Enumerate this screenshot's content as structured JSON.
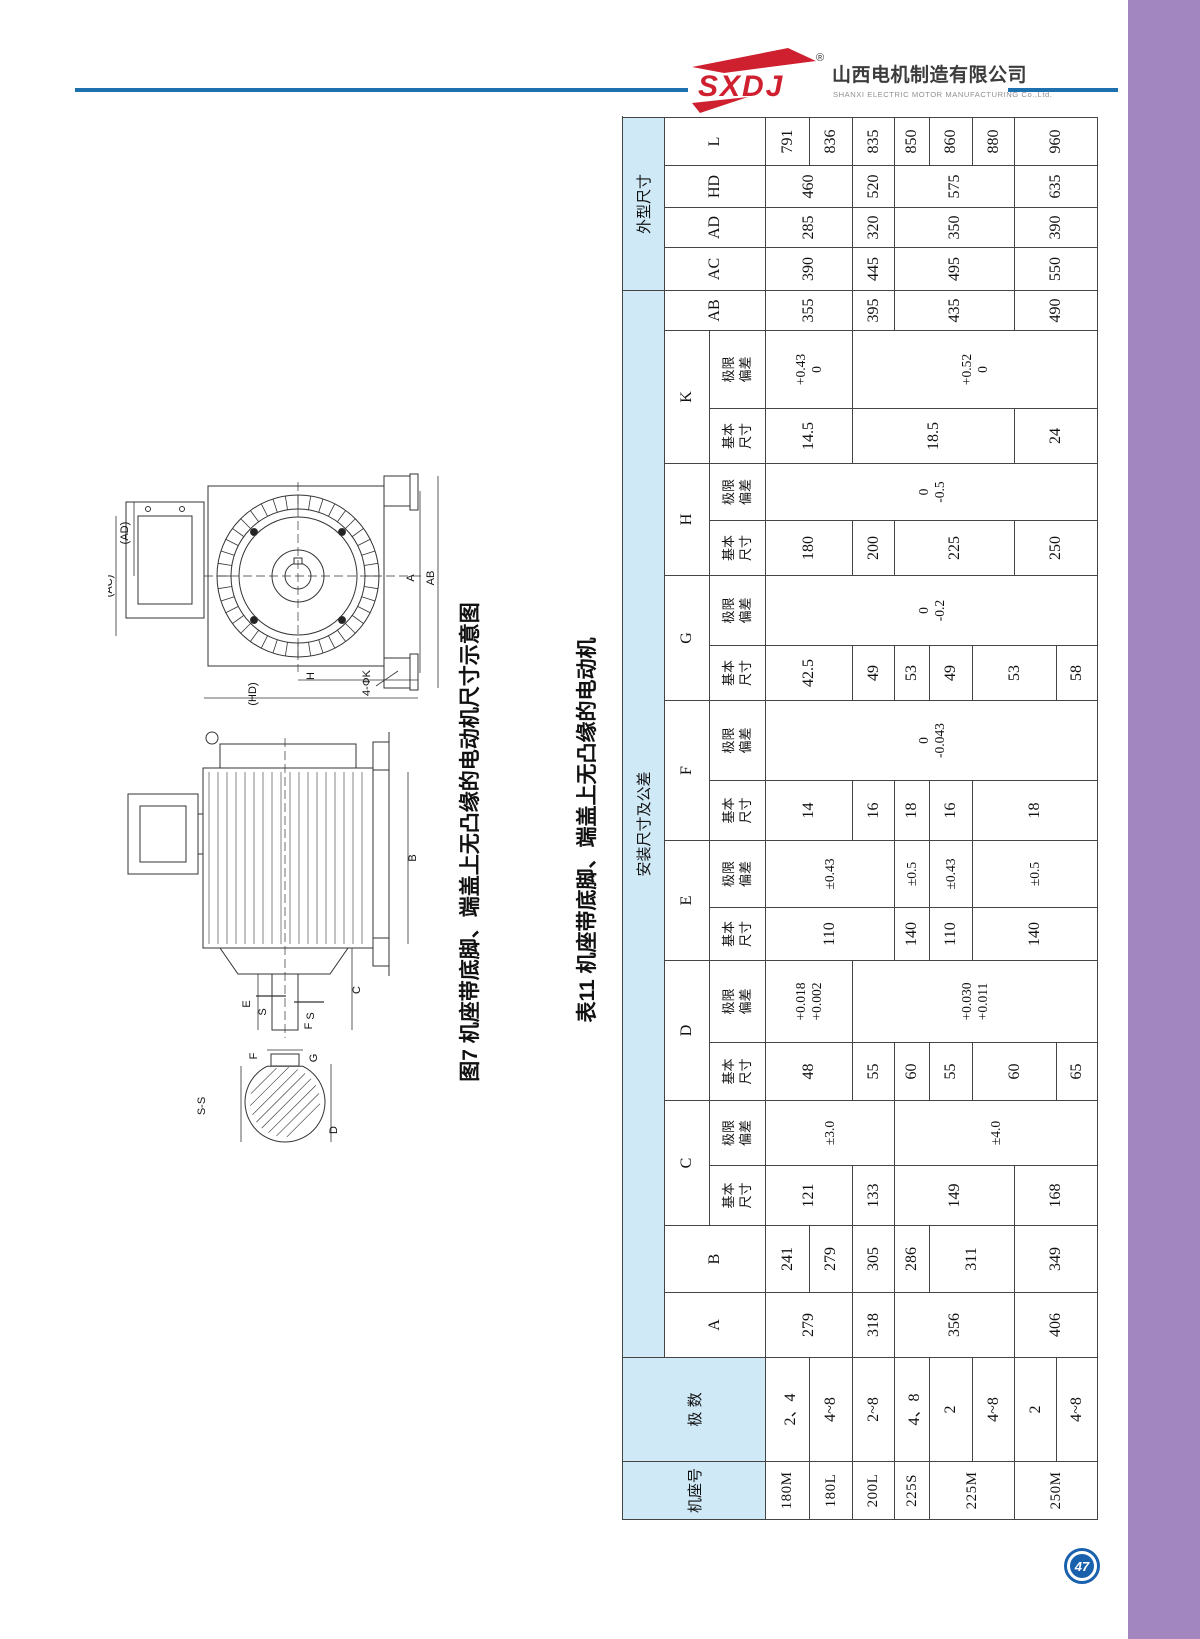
{
  "header": {
    "logo_text": "SXDJ",
    "registered_mark": "®",
    "company_cn": "山西电机制造有限公司",
    "company_en": "SHANXI ELECTRIC MOTOR MANUFACTURING Co.,Ltd.",
    "accent_color": "#1e6fad",
    "logo_red": "#cf2030"
  },
  "figure": {
    "fig7_caption": "图7 机座带底脚、端盖上无凸缘的电动机尺寸示意图",
    "table11_caption": "表11 机座带底脚、端盖上无凸缘的电动机",
    "front_labels": {
      "ad": "(AD)",
      "ac": "(AC)",
      "ab": "AB",
      "a": "A",
      "h": "H",
      "hd": "(HD)",
      "k4": "4-ΦK"
    },
    "side_labels": {
      "b": "B",
      "c": "C",
      "e": "E",
      "f": "F",
      "s1": "S",
      "s2": "S"
    },
    "section_labels": {
      "ss": "S-S",
      "f": "F",
      "g": "G",
      "d": "D"
    }
  },
  "table": {
    "col_widths": [
      58,
      104,
      65,
      67,
      60,
      65,
      58,
      82,
      53,
      67,
      60,
      80,
      55,
      70,
      55,
      57,
      55,
      78,
      40,
      43,
      40,
      42,
      48
    ],
    "row_heights": [
      42,
      45,
      56,
      44,
      43,
      42,
      35,
      43,
      42,
      42,
      41
    ],
    "grid": [
      [
        {
          "t": "机座号",
          "rs": 3,
          "c": "hd"
        },
        {
          "t": "极 数",
          "rs": 3,
          "c": "hd"
        },
        {
          "t": "安装尺寸及公差",
          "cs": 17,
          "c": "hd"
        },
        {
          "t": "外型尺寸",
          "cs": 5,
          "c": "hd"
        }
      ],
      [
        {
          "t": "A",
          "rs": 2,
          "c": "ltr"
        },
        {
          "t": "B",
          "rs": 2,
          "c": "ltr"
        },
        {
          "t": "C",
          "cs": 2,
          "c": "ltr"
        },
        {
          "t": "D",
          "cs": 2,
          "c": "ltr"
        },
        {
          "t": "E",
          "cs": 2,
          "c": "ltr"
        },
        {
          "t": "F",
          "cs": 2,
          "c": "ltr"
        },
        {
          "t": "G",
          "cs": 2,
          "c": "ltr"
        },
        {
          "t": "H",
          "cs": 2,
          "c": "ltr"
        },
        {
          "t": "K",
          "cs": 2,
          "c": "ltr"
        },
        {
          "t": "AB",
          "rs": 2,
          "c": "ltr"
        },
        {
          "t": "AC",
          "rs": 2,
          "c": "ltr"
        },
        {
          "t": "AD",
          "rs": 2,
          "c": "ltr"
        },
        {
          "t": "HD",
          "rs": 2,
          "c": "ltr"
        },
        {
          "t": "L",
          "rs": 2,
          "c": "ltr"
        }
      ],
      [
        {
          "t": "基本尺寸",
          "c": "sub"
        },
        {
          "t": "极限偏差",
          "c": "sub"
        },
        {
          "t": "基本尺寸",
          "c": "sub"
        },
        {
          "t": "极限偏差",
          "c": "sub"
        },
        {
          "t": "基本尺寸",
          "c": "sub"
        },
        {
          "t": "极限偏差",
          "c": "sub"
        },
        {
          "t": "基本尺寸",
          "c": "sub"
        },
        {
          "t": "极限偏差",
          "c": "sub"
        },
        {
          "t": "基本尺寸",
          "c": "sub"
        },
        {
          "t": "极限偏差",
          "c": "sub"
        },
        {
          "t": "基本尺寸",
          "c": "sub"
        },
        {
          "t": "极限偏差",
          "c": "sub"
        },
        {
          "t": "基本尺寸",
          "c": "sub"
        },
        {
          "t": "极限偏差",
          "c": "sub"
        }
      ],
      [
        {
          "t": "180M",
          "c": "frm"
        },
        {
          "t": "2、4"
        },
        {
          "t": "279",
          "rs": 2
        },
        {
          "t": "241"
        },
        {
          "t": "121",
          "rs": 2
        },
        {
          "t": "±3.0",
          "rs": 3,
          "c": "tol"
        },
        {
          "t": "48",
          "rs": 2
        },
        {
          "t": "+0.018\n+0.002",
          "rs": 2,
          "c": "tol"
        },
        {
          "t": "110",
          "rs": 3
        },
        {
          "t": "±0.43",
          "rs": 3,
          "c": "tol"
        },
        {
          "t": "14",
          "rs": 2
        },
        {
          "t": "0\n-0.043",
          "rs": 8,
          "c": "tol"
        },
        {
          "t": "42.5",
          "rs": 2
        },
        {
          "t": "0\n-0.2",
          "rs": 8,
          "c": "tol"
        },
        {
          "t": "180",
          "rs": 2
        },
        {
          "t": "0\n-0.5",
          "rs": 8,
          "c": "tol"
        },
        {
          "t": "14.5",
          "rs": 2
        },
        {
          "t": "+0.43\n0",
          "rs": 2,
          "c": "tol"
        },
        {
          "t": "355",
          "rs": 2
        },
        {
          "t": "390",
          "rs": 2
        },
        {
          "t": "285",
          "rs": 2
        },
        {
          "t": "460",
          "rs": 2
        },
        {
          "t": "791"
        }
      ],
      [
        {
          "t": "180L",
          "c": "frm"
        },
        {
          "t": "4~8"
        },
        {
          "t": "279"
        },
        {
          "t": "836"
        }
      ],
      [
        {
          "t": "200L",
          "c": "frm"
        },
        {
          "t": "2~8"
        },
        {
          "t": "318"
        },
        {
          "t": "305"
        },
        {
          "t": "133"
        },
        {
          "t": "55"
        },
        {
          "t": "+0.030\n+0.011",
          "rs": 6,
          "c": "tol"
        },
        {
          "t": "16"
        },
        {
          "t": "49"
        },
        {
          "t": "200"
        },
        {
          "t": "18.5",
          "rs": 4
        },
        {
          "t": "+0.52\n0",
          "rs": 6,
          "c": "tol"
        },
        {
          "t": "395"
        },
        {
          "t": "445"
        },
        {
          "t": "320"
        },
        {
          "t": "520"
        },
        {
          "t": "835"
        }
      ],
      [
        {
          "t": "225S",
          "c": "frm"
        },
        {
          "t": "4、8"
        },
        {
          "t": "356",
          "rs": 3
        },
        {
          "t": "286"
        },
        {
          "t": "149",
          "rs": 3
        },
        {
          "t": "±4.0",
          "rs": 5,
          "c": "tol"
        },
        {
          "t": "60"
        },
        {
          "t": "140"
        },
        {
          "t": "±0.5",
          "c": "tol"
        },
        {
          "t": "18"
        },
        {
          "t": "53"
        },
        {
          "t": "225",
          "rs": 3
        },
        {
          "t": "435",
          "rs": 3
        },
        {
          "t": "495",
          "rs": 3
        },
        {
          "t": "350",
          "rs": 3
        },
        {
          "t": "575",
          "rs": 3
        },
        {
          "t": "850"
        }
      ],
      [
        {
          "t": "225M",
          "rs": 2,
          "c": "frm"
        },
        {
          "t": "2"
        },
        {
          "t": "311",
          "rs": 2
        },
        {
          "t": "55"
        },
        {
          "t": "110"
        },
        {
          "t": "±0.43",
          "c": "tol"
        },
        {
          "t": "16"
        },
        {
          "t": "49"
        },
        {
          "t": "860"
        }
      ],
      [
        {
          "t": "4~8"
        },
        {
          "t": "60",
          "rs": 2
        },
        {
          "t": "140",
          "rs": 3
        },
        {
          "t": "±0.5",
          "rs": 3,
          "c": "tol"
        },
        {
          "t": "18",
          "rs": 3
        },
        {
          "t": "53",
          "rs": 2
        },
        {
          "t": "880"
        }
      ],
      [
        {
          "t": "250M",
          "rs": 2,
          "c": "frm"
        },
        {
          "t": "2"
        },
        {
          "t": "406",
          "rs": 2
        },
        {
          "t": "349",
          "rs": 2
        },
        {
          "t": "168",
          "rs": 2
        },
        {
          "t": "250",
          "rs": 2
        },
        {
          "t": "24",
          "rs": 2
        },
        {
          "t": "490",
          "rs": 2
        },
        {
          "t": "550",
          "rs": 2
        },
        {
          "t": "390",
          "rs": 2
        },
        {
          "t": "635",
          "rs": 2
        },
        {
          "t": "960",
          "rs": 2
        }
      ],
      [
        {
          "t": "4~8"
        },
        {
          "t": "65"
        },
        {
          "t": "58"
        }
      ]
    ]
  },
  "footer": {
    "page_number": "47"
  },
  "colors": {
    "purple_band": "#a286bf",
    "header_line": "#1e6fad",
    "table_header_bg": "#cfe9f7",
    "logo_red": "#cf2030",
    "page_badge_blue": "#1a61ad"
  }
}
